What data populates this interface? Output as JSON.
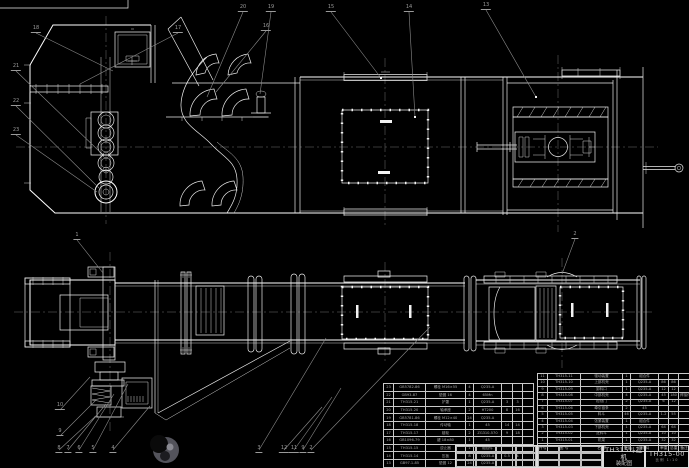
{
  "title_block": {
    "product": "TH315斗提机",
    "drawing_type": "装配图",
    "drawing_no": "TH315-00",
    "scale_note": "比例 1:10"
  },
  "bom_right": {
    "headers": [
      "件号",
      "图  号",
      "名  称",
      "数量",
      "材  料",
      "单重",
      "总重",
      "备注"
    ],
    "rows": [
      [
        "11",
        "TH315-11",
        "驱动装置",
        "1",
        "组合件",
        "",
        "",
        ""
      ],
      [
        "10",
        "TH315-10",
        "上部机壳",
        "1",
        "Q235-A",
        "86",
        "86",
        ""
      ],
      [
        "9",
        "TH315-09",
        "卸料口",
        "1",
        "Q235-A",
        "12",
        "12",
        ""
      ],
      [
        "8",
        "TH315-08",
        "中部机壳",
        "4",
        "Q235-A",
        "45",
        "180",
        "焊接件"
      ],
      [
        "7",
        "TH315-07",
        "检视门",
        "2",
        "Q235-A",
        "6",
        "12",
        ""
      ],
      [
        "6",
        "TH315-06",
        "牵引链条",
        "2",
        "45",
        "",
        "",
        ""
      ],
      [
        "5",
        "TH315-05",
        "料斗",
        "46",
        "Q235-A",
        "1.2",
        "55",
        ""
      ],
      [
        "4",
        "TH315-04",
        "张紧装置",
        "1",
        "组合件",
        "",
        "",
        ""
      ],
      [
        "3",
        "TH315-03",
        "下部机壳",
        "1",
        "Q235-A",
        "64",
        "64",
        ""
      ],
      [
        "2",
        "TH315-02",
        "进料斗",
        "1",
        "Q235-A",
        "10",
        "10",
        ""
      ],
      [
        "1",
        "TH315-01",
        "机架",
        "1",
        "Q235-A",
        "32",
        "32",
        ""
      ]
    ]
  },
  "bom_left": {
    "rows": [
      [
        "23",
        "GB5782-86",
        "螺栓 M16×55",
        "4",
        "Q235-A",
        "",
        "",
        ""
      ],
      [
        "22",
        "GB93-87",
        "垫圈 16",
        "4",
        "65Mn",
        "",
        "",
        ""
      ],
      [
        "21",
        "TH315-21",
        "护罩",
        "1",
        "Q235-A",
        "3",
        "3",
        ""
      ],
      [
        "20",
        "TH315-20",
        "轴承座",
        "2",
        "HT200",
        "8",
        "16",
        ""
      ],
      [
        "19",
        "GB5781-86",
        "螺栓 M12×40",
        "24",
        "Q235-A",
        "",
        "",
        ""
      ],
      [
        "18",
        "TH315-18",
        "传动轴",
        "1",
        "45",
        "14",
        "14",
        ""
      ],
      [
        "17",
        "TH315-17",
        "链轮",
        "2",
        "ZG310-570",
        "9",
        "18",
        ""
      ],
      [
        "16",
        "GB1096-79",
        "键 18×80",
        "1",
        "45",
        "",
        "",
        ""
      ],
      [
        "15",
        "TH315-15",
        "逆止器",
        "1",
        "组合件",
        "",
        "",
        ""
      ],
      [
        "14",
        "TH315-14",
        "压板",
        "8",
        "Q235-A",
        "0.5",
        "4",
        ""
      ],
      [
        "13",
        "GB97.1-85",
        "垫圈 12",
        "24",
        "Q235-A",
        "",
        "",
        ""
      ],
      [
        "12",
        "TH315-12",
        "观察窗",
        "2",
        "Q235-A",
        "2",
        "4",
        ""
      ]
    ]
  },
  "callouts": [
    {
      "x": 36,
      "y": 33,
      "n": "18"
    },
    {
      "x": 178,
      "y": 33,
      "n": "17"
    },
    {
      "x": 266,
      "y": 31,
      "n": "16"
    },
    {
      "x": 243,
      "y": 12,
      "n": "20"
    },
    {
      "x": 271,
      "y": 12,
      "n": "19"
    },
    {
      "x": 331,
      "y": 12,
      "n": "15"
    },
    {
      "x": 409,
      "y": 12,
      "n": "14"
    },
    {
      "x": 486,
      "y": 10,
      "n": "13"
    },
    {
      "x": 16,
      "y": 71,
      "n": "21"
    },
    {
      "x": 16,
      "y": 106,
      "n": "22"
    },
    {
      "x": 16,
      "y": 135,
      "n": "23"
    },
    {
      "x": 77,
      "y": 240,
      "n": "1"
    },
    {
      "x": 575,
      "y": 239,
      "n": "2"
    },
    {
      "x": 60,
      "y": 410,
      "n": "10"
    },
    {
      "x": 60,
      "y": 436,
      "n": "9"
    },
    {
      "x": 59,
      "y": 453,
      "n": "8"
    },
    {
      "x": 68,
      "y": 453,
      "n": "7"
    },
    {
      "x": 79,
      "y": 453,
      "n": "6"
    },
    {
      "x": 93,
      "y": 453,
      "n": "5"
    },
    {
      "x": 113,
      "y": 453,
      "n": "4"
    },
    {
      "x": 259,
      "y": 453,
      "n": "3"
    },
    {
      "x": 284,
      "y": 453,
      "n": "12"
    },
    {
      "x": 294,
      "y": 453,
      "n": "11"
    },
    {
      "x": 303,
      "y": 453,
      "n": "9"
    },
    {
      "x": 311,
      "y": 453,
      "n": "2"
    }
  ]
}
